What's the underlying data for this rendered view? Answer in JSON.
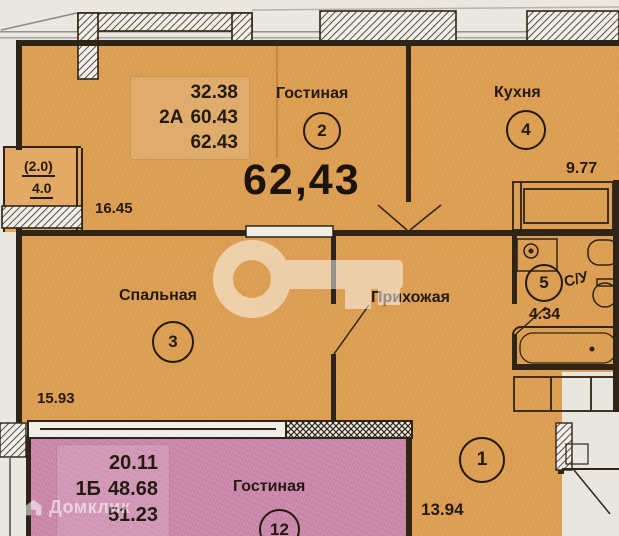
{
  "plan": {
    "watermark_brand": "Домклик",
    "apartment_2a": {
      "summary": {
        "area_living": "32.38",
        "unit_label": "2А",
        "area_units": "60.43",
        "area_total": "62.43"
      },
      "total_area_display": "62,43",
      "rooms": {
        "living": {
          "label": "Гостиная",
          "badge": "2",
          "dim": "16.45"
        },
        "kitchen": {
          "label": "Кухня",
          "badge": "4",
          "dim": "9.77"
        },
        "bedroom": {
          "label": "Спальная",
          "badge": "3",
          "dim": "15.93"
        },
        "hallway": {
          "label": "Прихожая",
          "badge": "1",
          "dim": "13.94"
        },
        "bathroom": {
          "label": "С/У",
          "badge": "5",
          "area": "4.34"
        },
        "balcony": {
          "factor_label": "(2.0)",
          "area": "4.0"
        }
      }
    },
    "apartment_1b": {
      "summary": {
        "area_living": "20.11",
        "unit_label": "1Б",
        "area_units": "48.68",
        "area_total": "51.23"
      },
      "rooms": {
        "living": {
          "label": "Гостиная",
          "badge": "12"
        }
      }
    }
  },
  "colors": {
    "apartment_2a_fill": "#dda055",
    "apartment_1b_fill": "#cf8db0",
    "balcony_fill": "#e2aa64",
    "wall": "#2e2417",
    "background": "#eae7e1",
    "text": "#241b10",
    "watermark": "rgba(255,255,255,0.55)"
  }
}
